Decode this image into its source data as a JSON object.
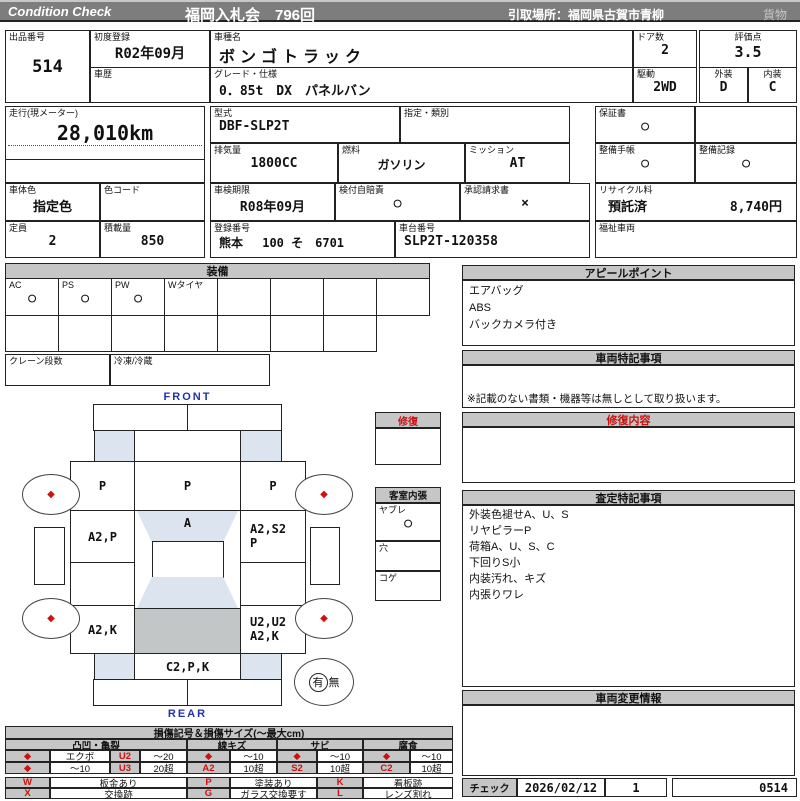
{
  "header": {
    "brand": "Condition  Check",
    "title": "福岡入札会　796回",
    "pickup": "引取場所：福岡県古賀市青柳",
    "category": "貨物"
  },
  "info": {
    "lot_label": "出品番号",
    "lot": "514",
    "first_reg_label": "初度登録",
    "first_reg": "R02年09月",
    "history_label": "車歴",
    "history": "",
    "model_name_label": "車種名",
    "model_name": "ボンゴトラック",
    "grade_label": "グレード・仕様",
    "grade": "0．85t　DX　パネルバン",
    "doors_label": "ドア数",
    "doors": "2",
    "score_label": "評価点",
    "score": "3.5",
    "drive_label": "駆動",
    "drive": "2WD",
    "exterior_label": "外装",
    "exterior": "D",
    "interior_label": "内装",
    "interior": "C",
    "mileage_label": "走行(現メーター)",
    "mileage": "28,010km",
    "model_code_label": "型式",
    "model_code": "DBF-SLP2T",
    "designation_label": "指定・類別",
    "designation": "",
    "displacement_label": "排気量",
    "displacement": "1800CC",
    "fuel_label": "燃料",
    "fuel": "ガソリン",
    "transmission_label": "ミッション",
    "transmission": "AT",
    "warranty_label": "保証書",
    "warranty": "○",
    "maintenance_book_label": "整備手帳",
    "maintenance_book": "○",
    "maintenance_record_label": "整備記録",
    "maintenance_record": "○",
    "body_color_label": "車体色",
    "body_color": "指定色",
    "color_code_label": "色コード",
    "color_code": "",
    "inspection_label": "車検期限",
    "inspection": "R08年09月",
    "insurance_label": "検付自賠責",
    "insurance": "○",
    "approval_label": "承認請求書",
    "approval": "×",
    "recycle_label": "リサイクル料",
    "recycle_status": "預託済",
    "recycle_fee": "8,740円",
    "capacity_label": "定員",
    "capacity": "2",
    "load_label": "積載量",
    "load": "850",
    "reg_number_label": "登録番号",
    "reg_number": "熊本　 100 そ　6701",
    "chassis_label": "車台番号",
    "chassis": "SLP2T-120358",
    "welfare_label": "福祉車両",
    "welfare": ""
  },
  "equipment": {
    "title": "装備",
    "row1": [
      {
        "label": "AC",
        "value": "○"
      },
      {
        "label": "PS",
        "value": "○"
      },
      {
        "label": "PW",
        "value": "○"
      },
      {
        "label": "Wタイヤ",
        "value": ""
      },
      {
        "label": "",
        "value": ""
      },
      {
        "label": "",
        "value": ""
      },
      {
        "label": "",
        "value": ""
      },
      {
        "label": "",
        "value": ""
      }
    ],
    "crane_label": "クレーン段数",
    "crane": "",
    "freezer_label": "冷凍/冷蔵",
    "freezer": ""
  },
  "panels": {
    "appeal": {
      "title": "アピールポイント",
      "lines": [
        "エアバッグ",
        "ABS",
        "バックカメラ付き"
      ]
    },
    "notes": {
      "title": "車両特記事項",
      "footnote": "※記載のない書類・機器等は無しとして取り扱います。"
    },
    "repair_content": {
      "title": "修復内容"
    },
    "assessment": {
      "title": "査定特記事項",
      "lines": [
        "外装色褪せA、U、S",
        "リヤピラーP",
        "荷箱A、U、S、C",
        "下回りS小",
        "内装汚れ、キズ",
        "内張りワレ"
      ]
    },
    "change_info": {
      "title": "車両変更情報"
    },
    "check": {
      "label": "チェック",
      "date": "2026/02/12",
      "count": "1",
      "number": "0514"
    }
  },
  "cabin": {
    "repair_title": "修復",
    "title": "客室内張",
    "items": [
      {
        "label": "ヤブレ",
        "value": "○"
      },
      {
        "label": "穴",
        "value": ""
      },
      {
        "label": "コゲ",
        "value": ""
      }
    ]
  },
  "diagram": {
    "front_label": "FRONT",
    "rear_label": "REAR",
    "front_left": "P",
    "front_center": "P",
    "front_right": "P",
    "left_door": "A2,P",
    "windshield": "A",
    "right_door_line1": "A2,S2",
    "right_door_line2": "P",
    "left_rear": "A2,K",
    "right_rear_line1": "U2,U2",
    "right_rear_line2": "A2,K",
    "rear_center": "C2,P,K",
    "spare_has": "有",
    "spare_none": "無"
  },
  "legend": {
    "title": "損傷記号＆損傷サイズ(〜最大cm)",
    "sec1": "凸凹・亀裂",
    "sec2": "線キズ",
    "sec3": "サビ",
    "sec4": "腐食",
    "r1": [
      "◆",
      "エクボ",
      "U2",
      "〜20",
      "◆",
      "〜10",
      "◆",
      "〜10",
      "◆",
      "〜10"
    ],
    "r2": [
      "◆",
      "〜10",
      "U3",
      "20超",
      "A2",
      "10超",
      "S2",
      "10超",
      "C2",
      "10超"
    ],
    "r3": [
      "W",
      "板金あり",
      "P",
      "塗装あり",
      "K",
      "看板跡"
    ],
    "r4": [
      "X",
      "交換跡",
      "G",
      "ガラス交換要す",
      "L",
      "レンズ割れ"
    ]
  },
  "colors": {
    "accent_red": "#cc1111",
    "header_gray": "#7d7d7d",
    "panel_gray": "#c6c6c6",
    "glass_blue": "#dbe4ef",
    "label_blue": "#2233aa"
  }
}
